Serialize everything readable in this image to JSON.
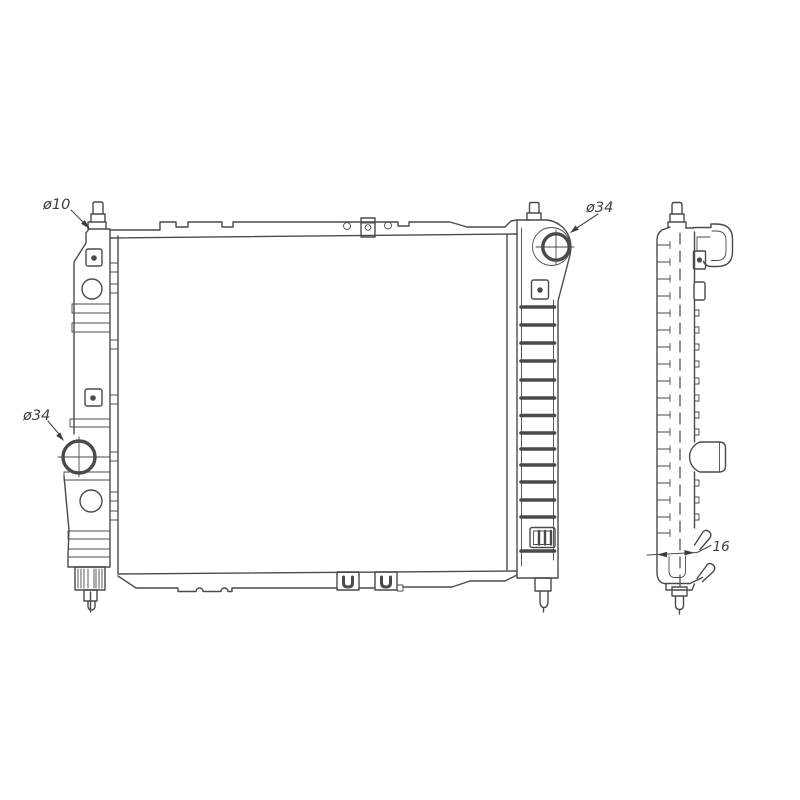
{
  "drawing": {
    "annotations": {
      "top_left_port_diameter": "ø10",
      "top_right_port_diameter": "ø34",
      "left_port_diameter": "ø34",
      "depth_dimension": "16"
    },
    "colors": {
      "background": "#ffffff",
      "line": "#4a4a4a",
      "text": "#3d3d3d"
    }
  }
}
